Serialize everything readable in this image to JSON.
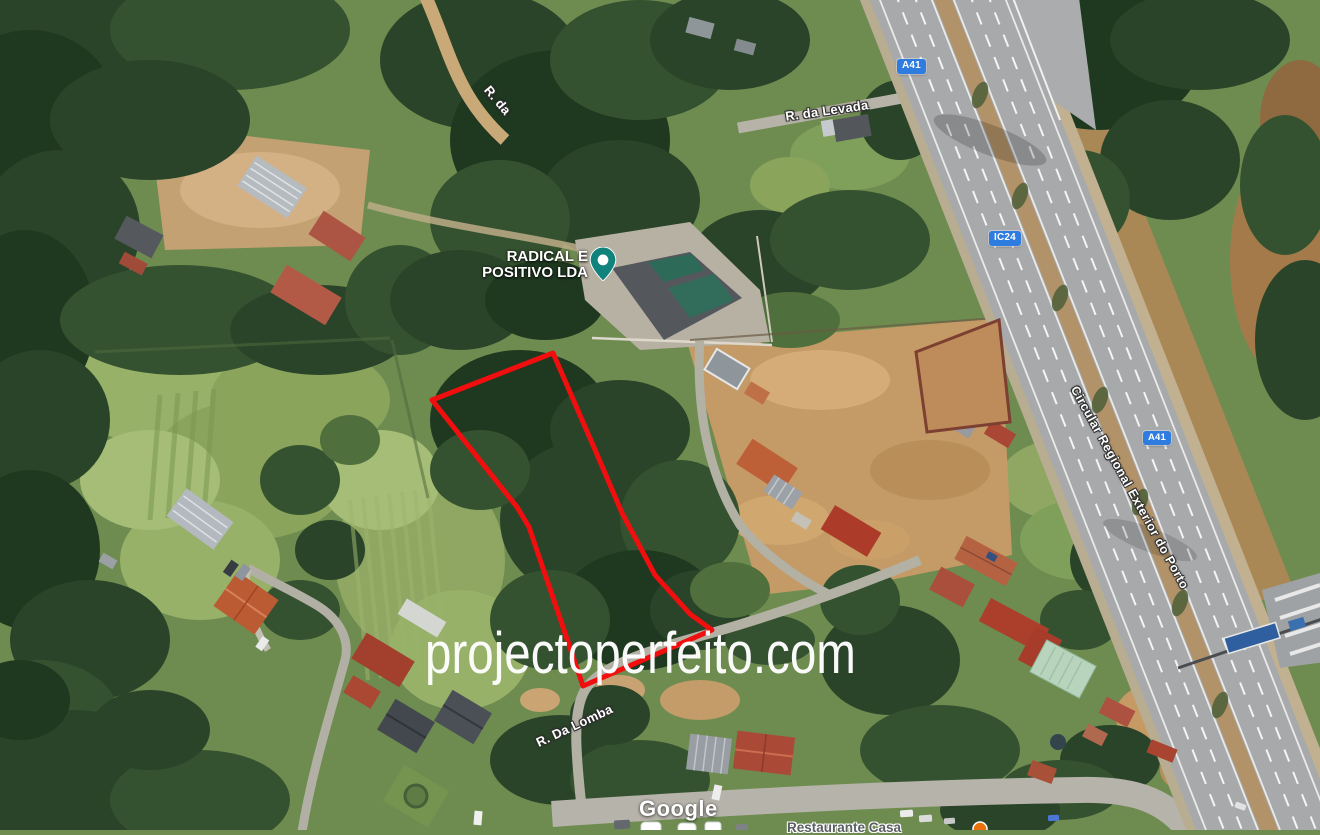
{
  "map": {
    "watermark_text": "projectoperfeito.com",
    "google_logo": "Google",
    "business": {
      "line1": "RADICAL E",
      "line2": "POSITIVO LDA",
      "pin_color": "#12837c"
    },
    "road_labels": {
      "top_partial": "R. da",
      "levada": "R. da Levada",
      "lomba": "R. Da Lomba",
      "highway": "Circular Regional Exterior do Porto"
    },
    "route_badges": {
      "a41_top": "A41",
      "ic24": "IC24",
      "a41_mid": "A41",
      "color": "#2e7ce0"
    },
    "poi_partial": {
      "text": "Restaurante Casa",
      "dot_color": "#e8710a"
    },
    "parcel": {
      "points": "553,353 432,400 517,507 529,527 583,686 712,630 690,614 655,575 622,513 596,452",
      "color": "#f10e0e"
    }
  }
}
